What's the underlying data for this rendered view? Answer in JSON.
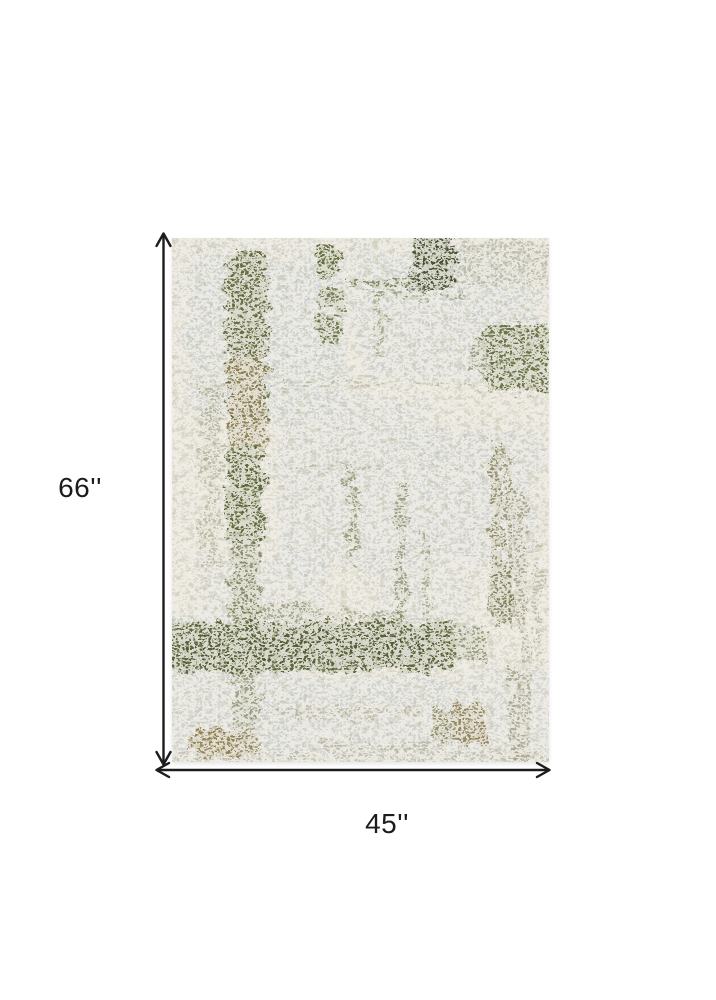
{
  "dimensions": {
    "height": {
      "label": "66''"
    },
    "width": {
      "label": "45''"
    }
  },
  "rug": {
    "alt": "Abstract distressed area rug in ivory, light gray and olive green"
  },
  "colors": {
    "canvas": "#ffffff",
    "arrow": "#1c1c1c",
    "label_text": "#1c1c1c",
    "rug_ivory": "#e7e3d6",
    "rug_gray": "#d2d6d5",
    "rug_olive": "#5e6638",
    "rug_band": "#545f30",
    "rug_dark_green": "#3c4a25",
    "rug_khaki": "#8a7a4c",
    "rug_tan": "#93835b"
  }
}
